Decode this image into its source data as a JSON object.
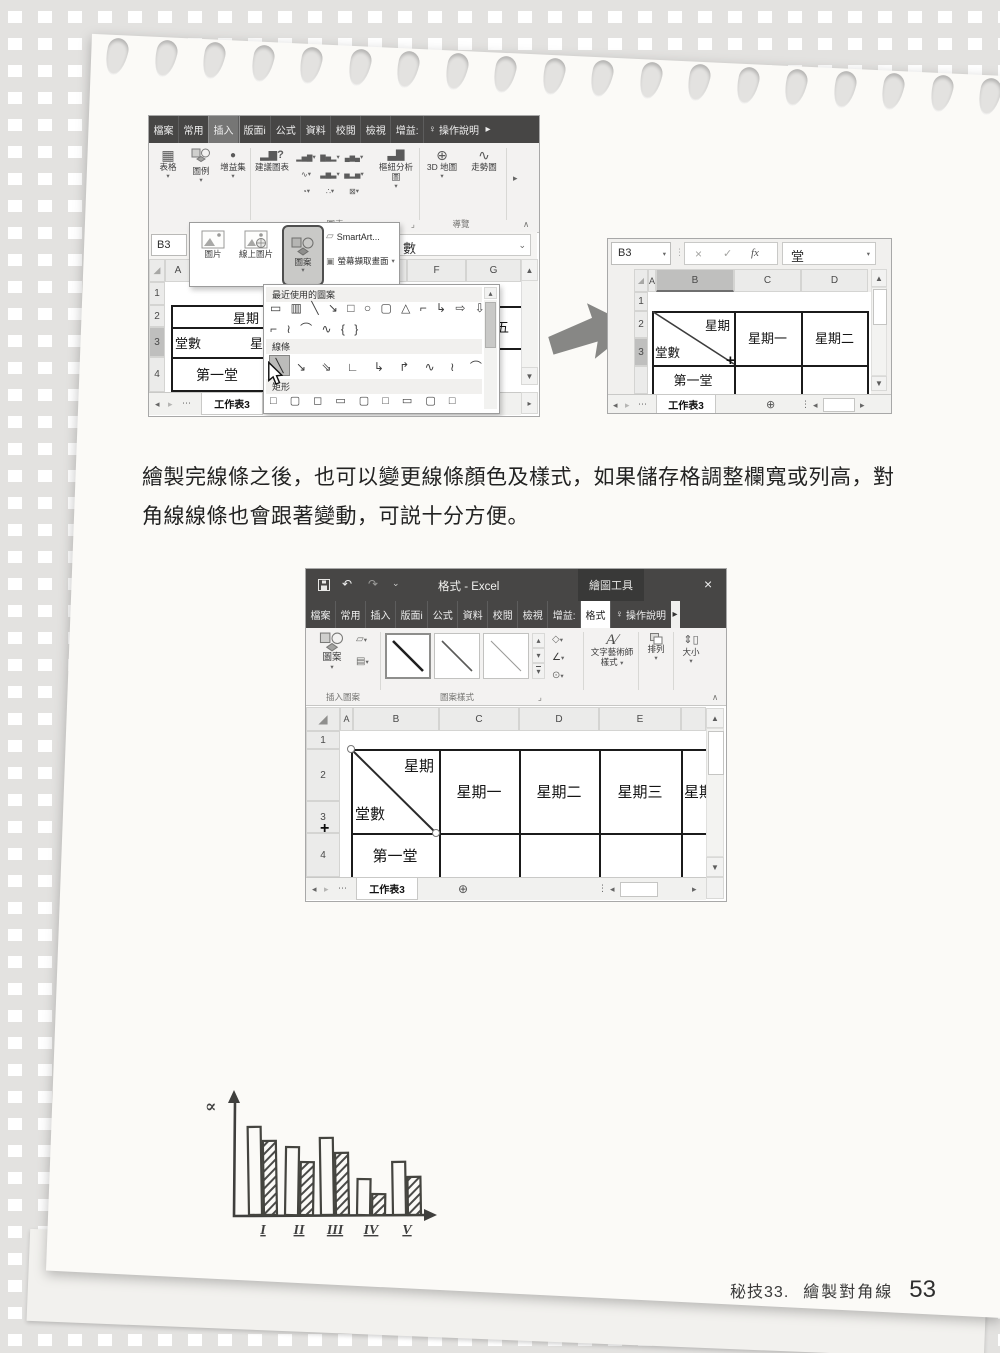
{
  "chart_data": {
    "type": "bar",
    "title": "",
    "xlabel": "",
    "ylabel": "∝",
    "categories": [
      "I",
      "II",
      "III",
      "IV",
      "V"
    ],
    "series": [
      {
        "name": "plain-bar",
        "values": [
          0.88,
          0.68,
          0.77,
          0.36,
          0.53
        ]
      },
      {
        "name": "hatched-bar",
        "values": [
          0.74,
          0.53,
          0.62,
          0.21,
          0.38
        ]
      }
    ],
    "ylim": [
      0,
      1
    ],
    "legend": "none",
    "grid": "off"
  },
  "paragraph": {
    "line1": "繪製完線條之後，也可以變更線條顏色及樣式，如果儲存格調整欄寬或列高，對",
    "line2": "角線線條也會跟著變動，可説十分方便。"
  },
  "footer": {
    "tip_no": "秘技33.",
    "tip_title": "繪製對角線",
    "page_no": "53"
  },
  "icons": {
    "table": "▦",
    "addin": "●",
    "suggest": "▂▆",
    "question": "?",
    "col": "▂▅▇",
    "bar": "▇▅▂",
    "area": "▄▆▄",
    "line": "∿",
    "combo": "▃▆▃",
    "hist": "▅▂▅",
    "pie": "◔",
    "scatter": "∴",
    "radar": "⊠",
    "pivot": "▃▇",
    "map": "⊕",
    "spark": "∿",
    "dd": "▾",
    "dd2": "⌄",
    "launcher": "⌟",
    "collapse": "∧",
    "left": "◂",
    "right": "▸",
    "up": "▴",
    "scroll_up": "▲",
    "scroll_down": "▼",
    "more": "⋯",
    "dots_v": "⋮",
    "plus_circle": "⊕",
    "select_all": "◢",
    "undo": "↶",
    "redo": "↷",
    "close": "×",
    "bulb": "♀",
    "cancel": "×",
    "check": "✓",
    "fx": "fx",
    "fill": "◇",
    "outline": "∠",
    "effects": "⊙",
    "editshape": "▱",
    "textbox": "▤",
    "smartart": "▱",
    "screenclip": "▣",
    "size_v": "⇕",
    "size_box": "▯",
    "wordart": "A",
    "slash": "∕",
    "cross": "+"
  },
  "shotA": {
    "tabs": [
      "檔案",
      "常用",
      "插入",
      "版面i",
      "公式",
      "資料",
      "校閱",
      "檢視",
      "增益:"
    ],
    "help_tab": "操作說明",
    "ribbon": {
      "table": "表格",
      "illustrations": "圖例",
      "addins": "增益集",
      "recommended": "建議圖表",
      "pivot": "樞紐分析圖",
      "map": "3D 地圖",
      "spark": "走勢圖",
      "chart_group": "圖表",
      "tours_group": "導覽"
    },
    "name_box": "B3",
    "formula_text": "數",
    "flyout": {
      "picture": "圖片",
      "online_picture": "線上圖片",
      "shapes": "圖案",
      "smartart": "SmartArt...",
      "screen_clip": "螢幕擷取畫面"
    },
    "columns": {
      "a": "A",
      "f": "F",
      "g": "G"
    },
    "rows": [
      "1",
      "2",
      "3",
      "4"
    ],
    "cells": {
      "b2": "星期",
      "b3": "堂數",
      "c3_partial": "星",
      "b4": "第一堂",
      "right_cell": "五"
    },
    "sheet_tab": "工作表3",
    "menu": {
      "recent_label": "最近使用的圖案",
      "recent_row1": "▭ ▥ ╲ ↘ □ ○ ▢ △ ⌐ ↳ ⇨ ⇩",
      "recent_row2": "⌐ ≀ ⌒ ∿ { }",
      "lines_label": "線條",
      "line_selected": "╲",
      "lines_row": "↘ ⇘ ∟ ↳ ↱ ∿ ≀ ⌒",
      "rect_label": "矩形",
      "rect_row": "□ ▢ ◻ ▭ ▢ □ ▭ ▢ □"
    }
  },
  "shotB": {
    "name_box": "B3",
    "cell_value": "堂",
    "columns": [
      "A",
      "B",
      "C",
      "D"
    ],
    "rows": [
      "1",
      "2",
      "3"
    ],
    "cells": {
      "b2": "星期",
      "b3": "堂數",
      "c23": "星期一",
      "d23": "星期二",
      "b4": "第一堂"
    },
    "sheet_tab": "工作表3"
  },
  "shotC": {
    "window_title": "格式 - Excel",
    "context_title": "繪圖工具",
    "tabs": [
      "檔案",
      "常用",
      "插入",
      "版面i",
      "公式",
      "資料",
      "校閱",
      "檢視",
      "增益:"
    ],
    "format_tab": "格式",
    "help_tab": "操作說明",
    "ribbon": {
      "shapes": "圖案",
      "insert_shapes_group": "插入圖案",
      "shape_styles_group": "圖案樣式",
      "wordart_label": "文字藝術師",
      "wordart_label2": "樣式",
      "arrange": "排列",
      "size": "大小"
    },
    "columns": [
      "A",
      "B",
      "C",
      "D",
      "E"
    ],
    "rows": [
      "1",
      "2",
      "3",
      "4"
    ],
    "cells": {
      "b23_top": "星期",
      "b23_bottom": "堂數",
      "c": "星期一",
      "d": "星期二",
      "e": "星期三",
      "f_partial": "星期",
      "b4": "第一堂"
    },
    "sheet_tab": "工作表3"
  }
}
